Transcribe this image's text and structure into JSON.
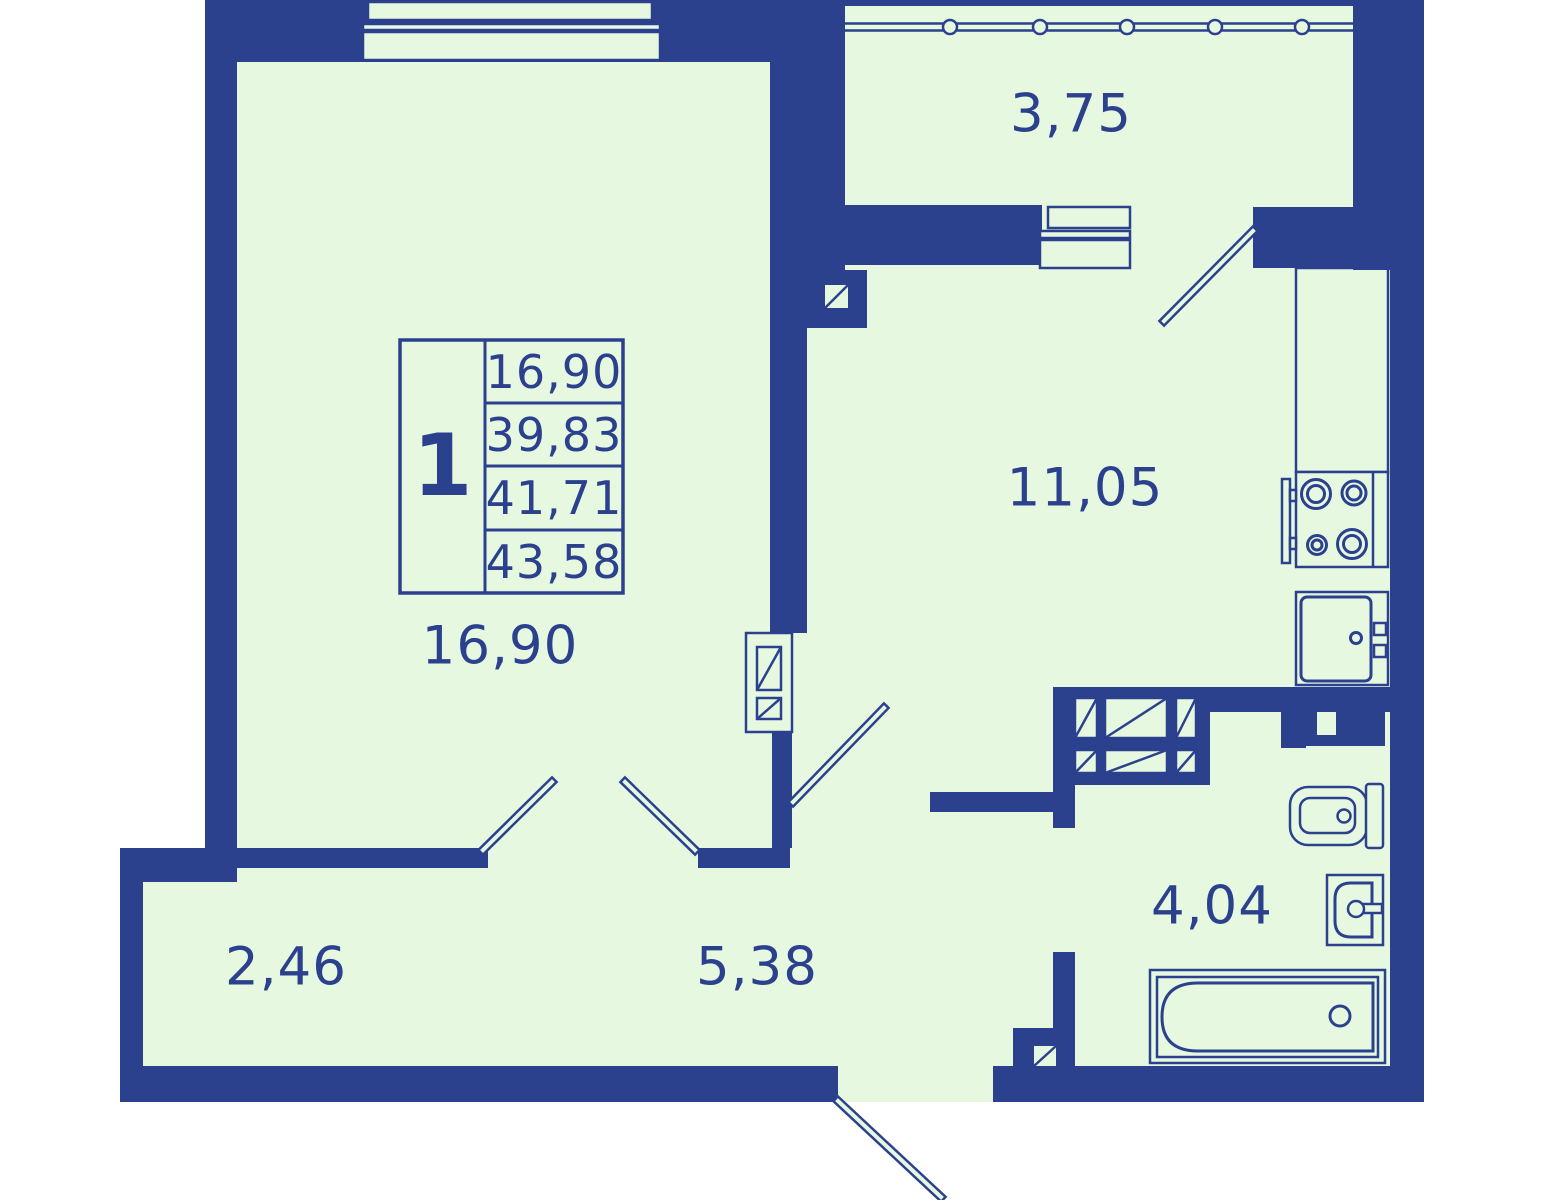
{
  "plan": {
    "title": "1-room apartment floor plan",
    "info_table": {
      "rooms_count": "1",
      "rows": [
        "16,90",
        "39,83",
        "41,71",
        "43,58"
      ]
    },
    "rooms": [
      {
        "name": "balcony",
        "area": "3,75"
      },
      {
        "name": "kitchen",
        "area": "11,05"
      },
      {
        "name": "living-room",
        "area": "16,90"
      },
      {
        "name": "hallway",
        "area": "2,46"
      },
      {
        "name": "corridor",
        "area": "5,38"
      },
      {
        "name": "bathroom",
        "area": "4,04"
      }
    ],
    "colors": {
      "wall": "#2b418e",
      "floor": "#e7f8e1",
      "background": "#ffffff"
    }
  }
}
